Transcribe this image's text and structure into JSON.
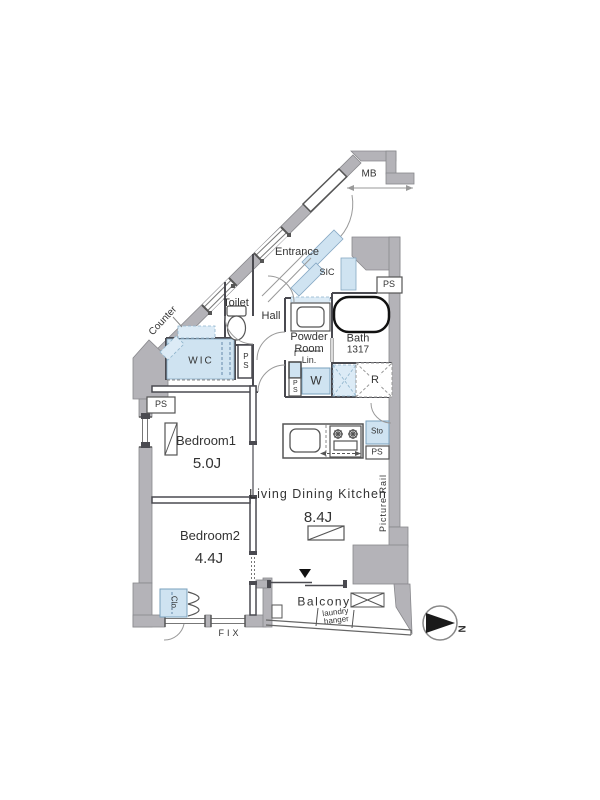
{
  "floorplan": {
    "rooms": {
      "ldk": {
        "name": "Living Dining Kitchen",
        "size": "8.4J"
      },
      "bedroom1": {
        "name": "Bedroom1",
        "size": "5.0J"
      },
      "bedroom2": {
        "name": "Bedroom2",
        "size": "4.4J"
      },
      "bath": {
        "name": "Bath",
        "size": "1317"
      },
      "powder_room": {
        "line1": "Powder",
        "line2": "Room"
      },
      "toilet": "Toilet",
      "hall": "Hall",
      "entrance": "Entrance",
      "wic": "WIC",
      "sic": "SIC",
      "balcony": "Balcony"
    },
    "features": {
      "mb": "MB",
      "ps": "PS",
      "counter": "Counter",
      "lin": "Lin.",
      "washer": "W",
      "fridge": "R",
      "sto": "Sto",
      "clo": "Clo.",
      "fix": "FIX",
      "picture_rail": "Picture Rail",
      "laundry_hanger": {
        "line1": "laundry",
        "line2": "hanger"
      }
    },
    "compass": {
      "north": "N"
    },
    "colors": {
      "wall": "#b4b3b8",
      "fixture_blue": "#cfe3f1",
      "line": "#4a4a50"
    }
  }
}
